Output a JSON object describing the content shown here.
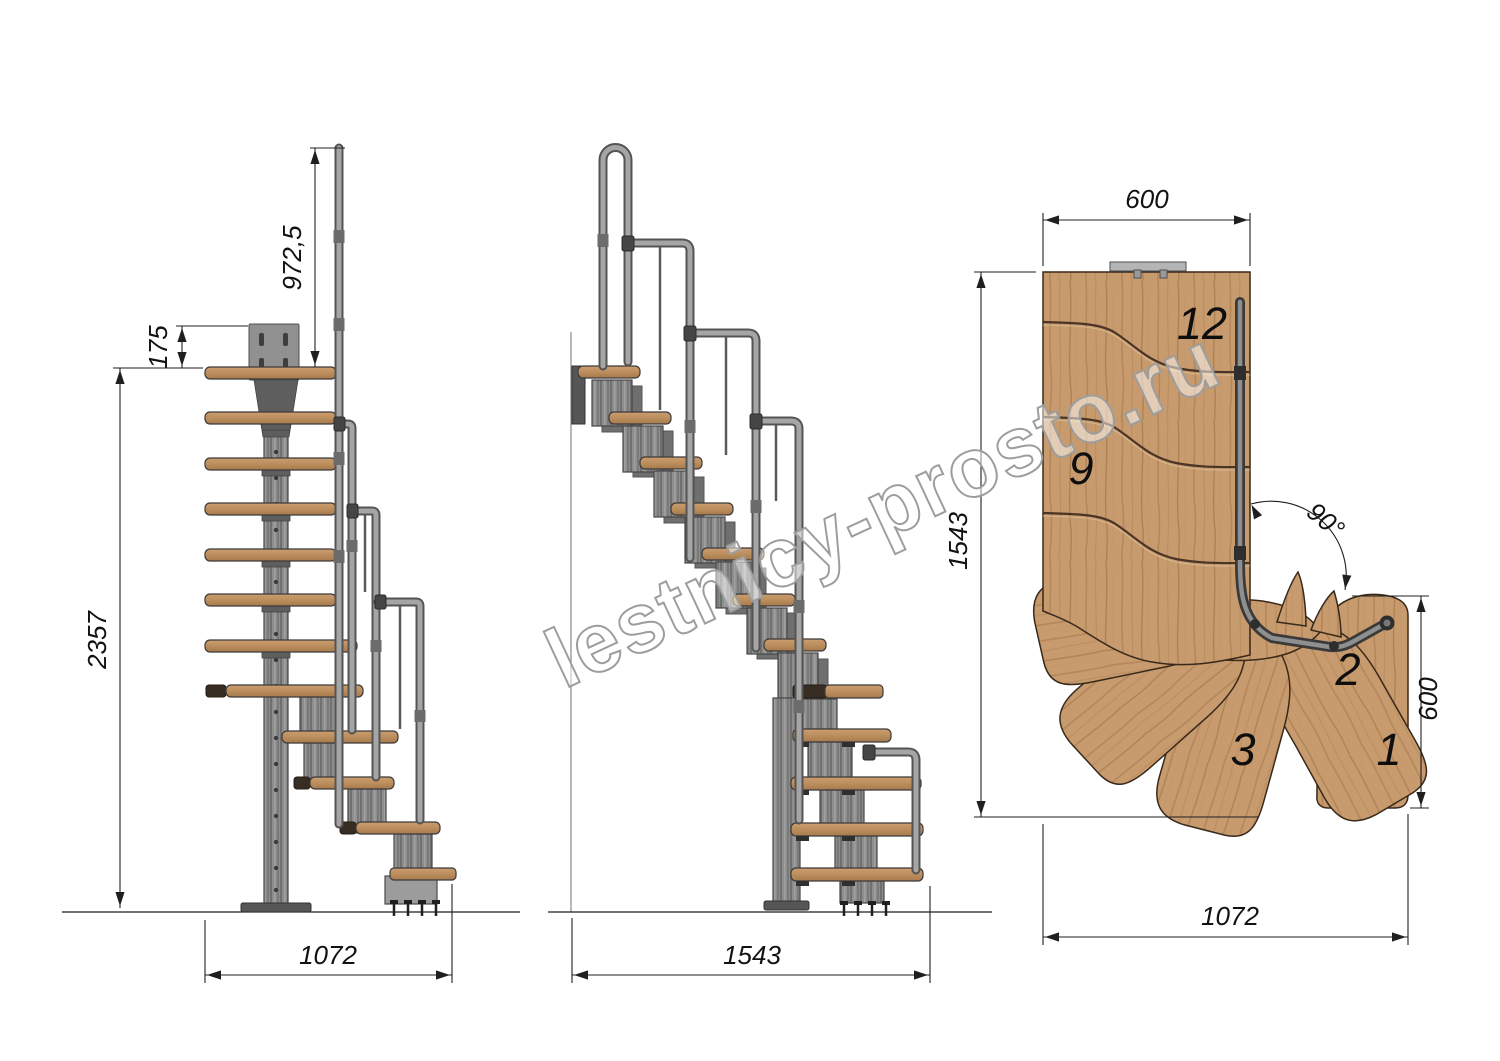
{
  "drawing": {
    "watermark": "lestnicy-prosto.ru",
    "side_view": {
      "dims": {
        "rail_height": "972,5",
        "top_offset": "175",
        "total_height": "2357",
        "base_width": "1072"
      }
    },
    "front_view": {
      "dims": {
        "base_width": "1543"
      }
    },
    "plan_view": {
      "dims": {
        "top_width": "600",
        "left_length": "1543",
        "turn_angle": "90°",
        "right_width": "600",
        "bottom_width": "1072"
      },
      "steps": {
        "s12": "12",
        "s9": "9",
        "s3": "3",
        "s2": "2",
        "s1": "1"
      }
    },
    "colors": {
      "wood": "#c79b6e",
      "wood_grain": "#a87e52",
      "wood_cap_dark": "#382d22",
      "metal": "#8d8d8d",
      "metal_dark": "#4e4e4e",
      "line": "#1f1f1f",
      "watermark": "#9d9d9d",
      "background": "#ffffff"
    }
  }
}
